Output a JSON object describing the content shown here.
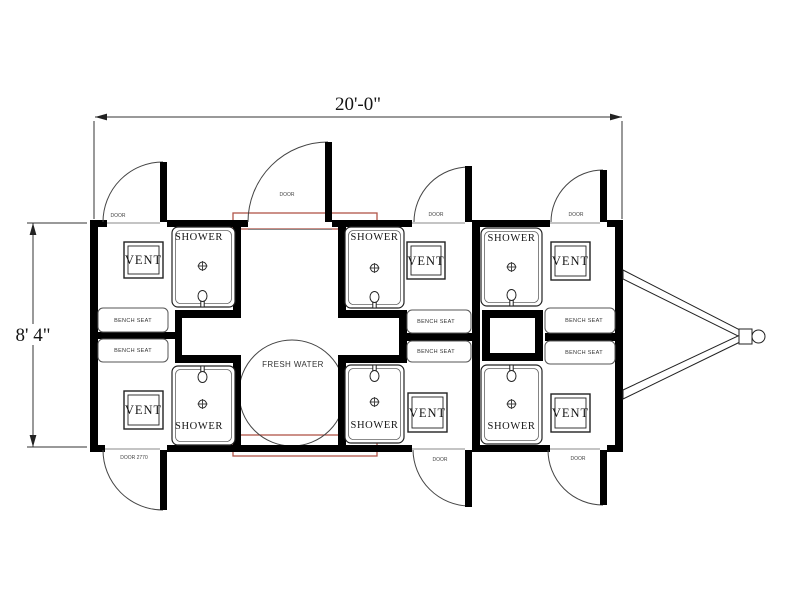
{
  "dimensions": {
    "width": "20'-0\"",
    "height": "8' 4\""
  },
  "labels": {
    "shower": "SHOWER",
    "vent": "VENT",
    "bench_seat": "BENCH SEAT",
    "fresh_water": "FRESH WATER",
    "door": "DOOR",
    "door_entry": "DOOR 2770"
  },
  "features": {
    "showers": 6,
    "vents": 6,
    "bench_seats": 6,
    "doors": 7,
    "fresh_water_tanks": 1
  },
  "colors": {
    "walls": "#000000",
    "lines": "#444444",
    "highlight": "#b15449",
    "background": "#ffffff"
  }
}
